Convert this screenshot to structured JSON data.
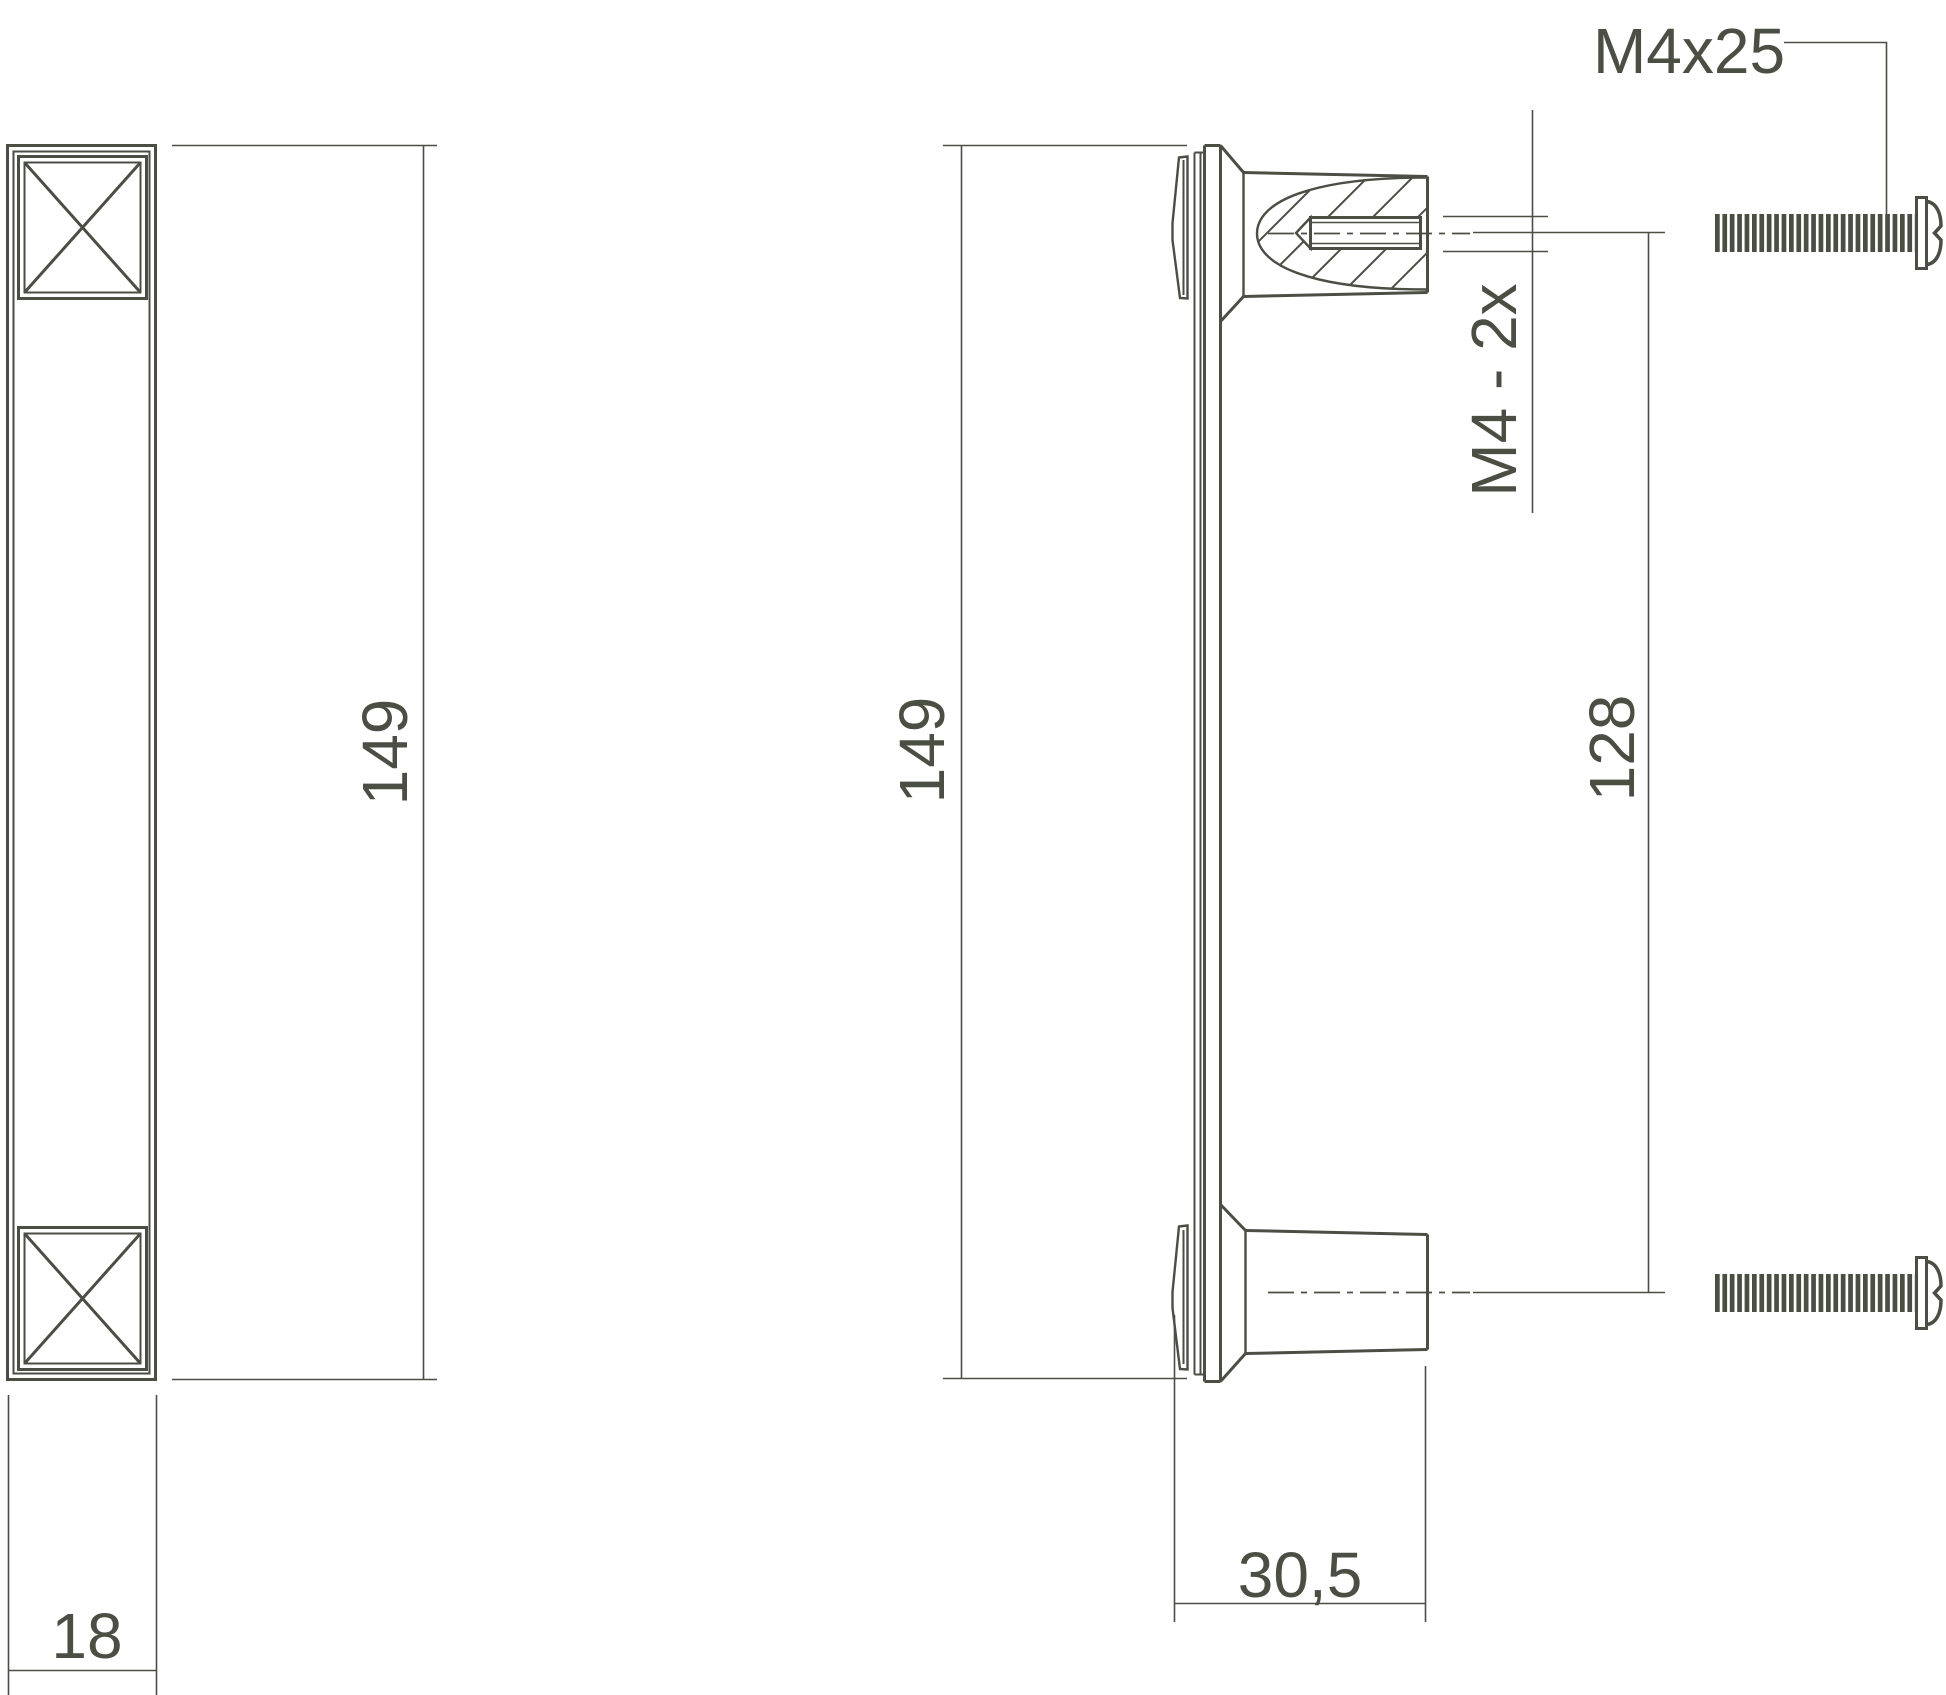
{
  "drawing": {
    "type": "technical-drawing",
    "description": "Furniture pull handle, front view and sectioned side view with fixing screws",
    "colors": {
      "line": "#4b4e43",
      "background": "#ffffff"
    },
    "views": {
      "front": {
        "height_label": "149",
        "width_label": "18"
      },
      "side": {
        "height_label": "149",
        "hole_spacing_label": "128",
        "post_depth_label": "30,5",
        "thread_label": "M4 - 2x"
      },
      "hardware": {
        "screw_label": "M4x25",
        "screw_count": 2
      }
    }
  }
}
